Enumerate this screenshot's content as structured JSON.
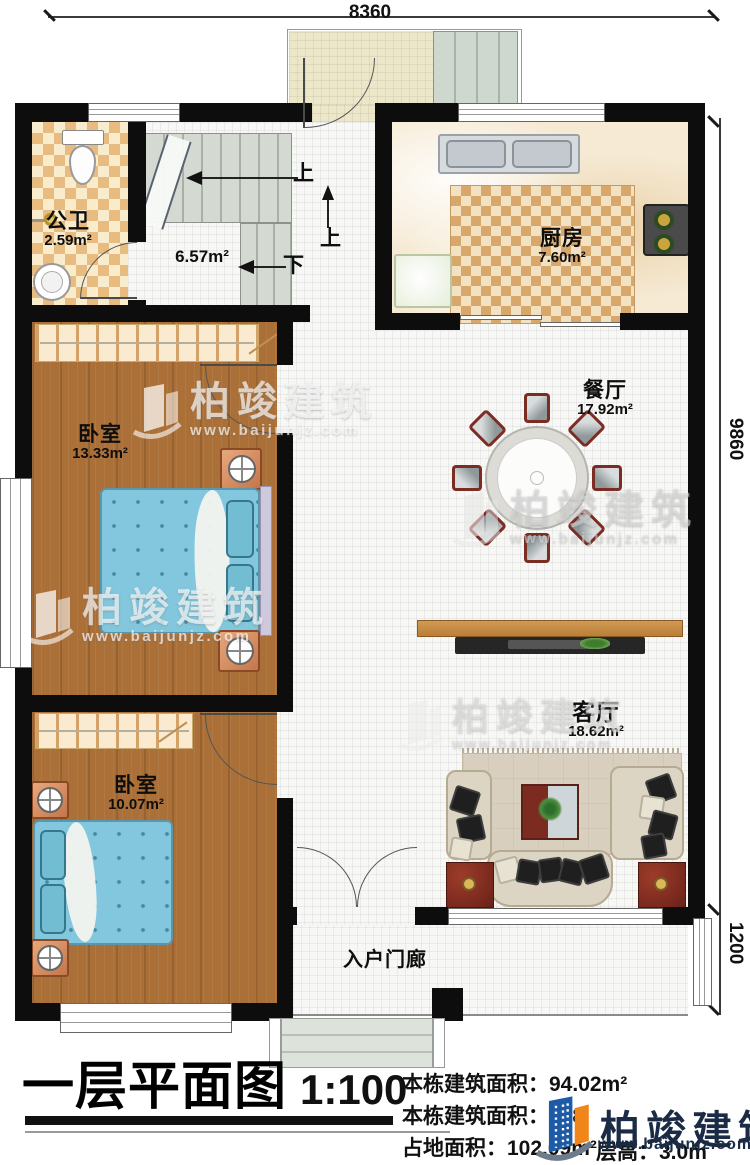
{
  "dims": {
    "top": "8360",
    "right_upper": "9860",
    "right_lower": "1200"
  },
  "rooms": {
    "bathroom": {
      "name": "公卫",
      "area": "2.59m²"
    },
    "stair_hall": {
      "area": "6.57m²"
    },
    "kitchen": {
      "name": "厨房",
      "area": "7.60m²"
    },
    "dining": {
      "name": "餐厅",
      "area": "17.92m²"
    },
    "bedroom_top": {
      "name": "卧室",
      "area": "13.33m²"
    },
    "bedroom_bottom": {
      "name": "卧室",
      "area": "10.07m²"
    },
    "living": {
      "name": "客厅",
      "area": "18.62m²"
    },
    "porch": {
      "name": "入户门廊"
    }
  },
  "stairs": {
    "up": "上",
    "up_mid": "上",
    "down": "下"
  },
  "footer": {
    "plan_title": "一层平面图",
    "scale": "1:100",
    "stats": [
      {
        "label": "本栋建筑面积：",
        "value": "94.02m²"
      },
      {
        "label": "本栋建筑面积：",
        "value": "188."
      },
      {
        "label": "占地面积：",
        "value": "102.09m²"
      },
      {
        "label": "层高：",
        "value": "3.0m"
      }
    ]
  },
  "brand": {
    "name": "柏竣建筑",
    "url": "www.baijunjz.com"
  }
}
